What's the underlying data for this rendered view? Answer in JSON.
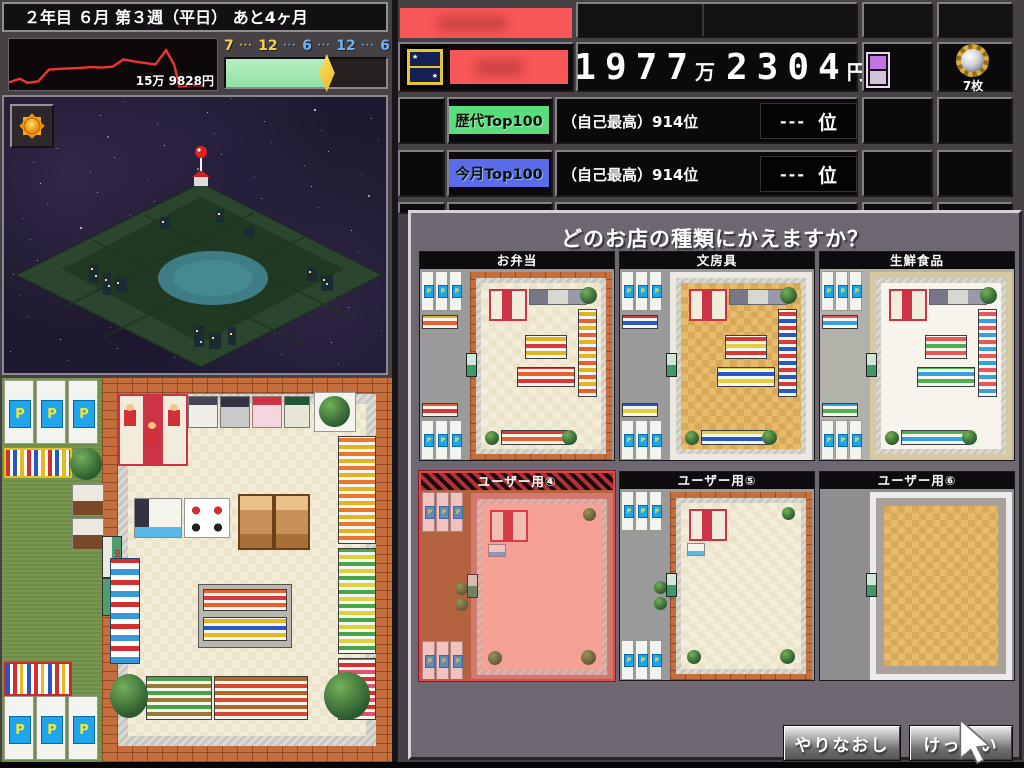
{
  "status_bar": {
    "text": "２年目 ６月 第３週（平日） あと4ヶ月"
  },
  "sales_graph": {
    "value_label": "15万 9828円",
    "points": [
      [
        0,
        85
      ],
      [
        4,
        78
      ],
      [
        7,
        86
      ],
      [
        11,
        83
      ],
      [
        15,
        60
      ],
      [
        21,
        58
      ],
      [
        26,
        57
      ],
      [
        31,
        55
      ],
      [
        35,
        56
      ],
      [
        39,
        54
      ],
      [
        43,
        40
      ],
      [
        47,
        44
      ],
      [
        51,
        47
      ],
      [
        55,
        50
      ],
      [
        59,
        22
      ],
      [
        62,
        50
      ],
      [
        64,
        93
      ],
      [
        69,
        90
      ],
      [
        73,
        91
      ]
    ]
  },
  "time_bar": {
    "progress": 0.63,
    "tokens": [
      {
        "t": "7",
        "c": "#f8d245"
      },
      {
        "t": "···",
        "c": "#f8d245"
      },
      {
        "t": "12",
        "c": "#f8d245"
      },
      {
        "t": "···",
        "c": "#6fb1f5"
      },
      {
        "t": "6",
        "c": "#6fb1f5"
      },
      {
        "t": "···",
        "c": "#6fb1f5"
      },
      {
        "t": "12",
        "c": "#6fb1f5"
      },
      {
        "t": "···",
        "c": "#6fb1f5"
      },
      {
        "t": "6",
        "c": "#6fb1f5"
      }
    ]
  },
  "money": {
    "main": "1977",
    "unit_main": "万",
    "sub": "2304",
    "unit_sub": "円"
  },
  "coins": {
    "label": "7枚"
  },
  "rankings": [
    {
      "badge": "歴代Top100",
      "badge_color": "#5bdc7d",
      "self_best": "（自己最高）914位",
      "rank": "---",
      "rank_unit": "位"
    },
    {
      "badge": "今月Top100",
      "badge_color": "#5a6cea",
      "self_best": "（自己最高）914位",
      "rank": "---",
      "rank_unit": "位"
    }
  ],
  "dialog": {
    "title": "どのお店の種類にかえますか？",
    "cards": [
      {
        "label": "お弁当",
        "selected": false
      },
      {
        "label": "文房具",
        "selected": false
      },
      {
        "label": "生鮮食品",
        "selected": false
      },
      {
        "label": "ユーザー用④",
        "selected": true
      },
      {
        "label": "ユーザー用⑤",
        "selected": false
      },
      {
        "label": "ユーザー用⑥",
        "selected": false
      }
    ],
    "buttons": {
      "redo": "やりなおし",
      "confirm": "けってい"
    }
  },
  "store_map": {
    "out_label": "OUT",
    "in_label": "IN",
    "parking_label": "P"
  }
}
